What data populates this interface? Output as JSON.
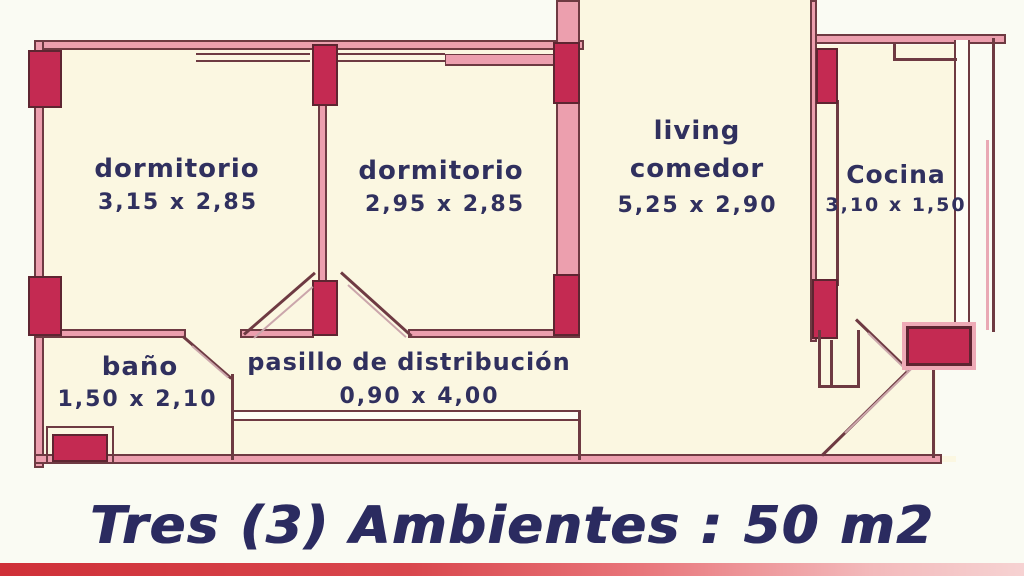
{
  "plan": {
    "rooms": {
      "bedroom1": {
        "label": "dormitorio",
        "dims": "3,15 x 2,85"
      },
      "bedroom2": {
        "label": "dormitorio",
        "dims": "2,95 x 2,85"
      },
      "living": {
        "label_line1": "living",
        "label_line2": "comedor",
        "dims": "5,25 x 2,90"
      },
      "kitchen": {
        "label": "Cocina",
        "dims": "3,10 x 1,50"
      },
      "bathroom": {
        "label": "baño",
        "dims": "1,50 x 2,10"
      },
      "hallway": {
        "label": "pasillo de distribución",
        "dims": "0,90 x 4,00"
      }
    },
    "footer": {
      "title": "Tres (3) Ambientes : 50 m2"
    },
    "colors": {
      "background": "#fafbf3",
      "room_fill": "#fbf7e1",
      "wall_pink": "#ec9fae",
      "wall_outline": "#6e3a42",
      "column_red": "#c42a52",
      "label_navy": "#30305e",
      "banner_red": "#cf3038",
      "banner_pink": "#f6d2d2"
    }
  }
}
